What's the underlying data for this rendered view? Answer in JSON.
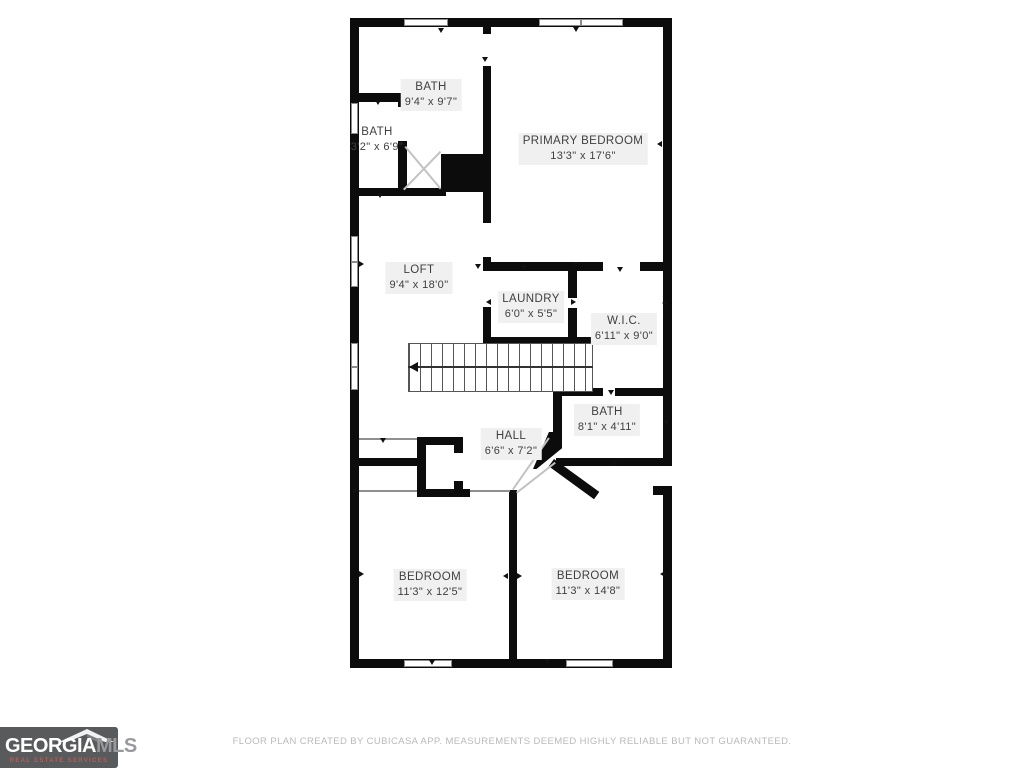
{
  "rooms": [
    {
      "name": "BATH",
      "dims": "9'4\" x 9'7\""
    },
    {
      "name": "BATH",
      "dims": "3'2\" x 6'9\""
    },
    {
      "name": "PRIMARY BEDROOM",
      "dims": "13'3\" x 17'6\""
    },
    {
      "name": "LOFT",
      "dims": "9'4\" x 18'0\""
    },
    {
      "name": "LAUNDRY",
      "dims": "6'0\" x 5'5\""
    },
    {
      "name": "W.I.C.",
      "dims": "6'11\" x 9'0\""
    },
    {
      "name": "BATH",
      "dims": "8'1\" x 4'11\""
    },
    {
      "name": "HALL",
      "dims": "6'6\" x 7'2\""
    },
    {
      "name": "BEDROOM",
      "dims": "11'3\" x 12'5\""
    },
    {
      "name": "BEDROOM",
      "dims": "11'3\" x 14'8\""
    }
  ],
  "footer": {
    "disclaimer": "FLOOR PLAN CREATED BY CUBICASA APP. MEASUREMENTS DEEMED HIGHLY RELIABLE BUT NOT GUARANTEED.",
    "logo": {
      "brand_primary": "GEORGIA",
      "brand_secondary": "MLS",
      "tagline": "REAL ESTATE SERVICES"
    }
  },
  "colors": {
    "wall": "#0c0c0c",
    "label_text": "#3f3f3f",
    "logo_background": "#595a5c",
    "logo_mls": "#97999c",
    "logo_tagline": "#a8625d",
    "disclaimer_text": "#b9b9b9"
  }
}
